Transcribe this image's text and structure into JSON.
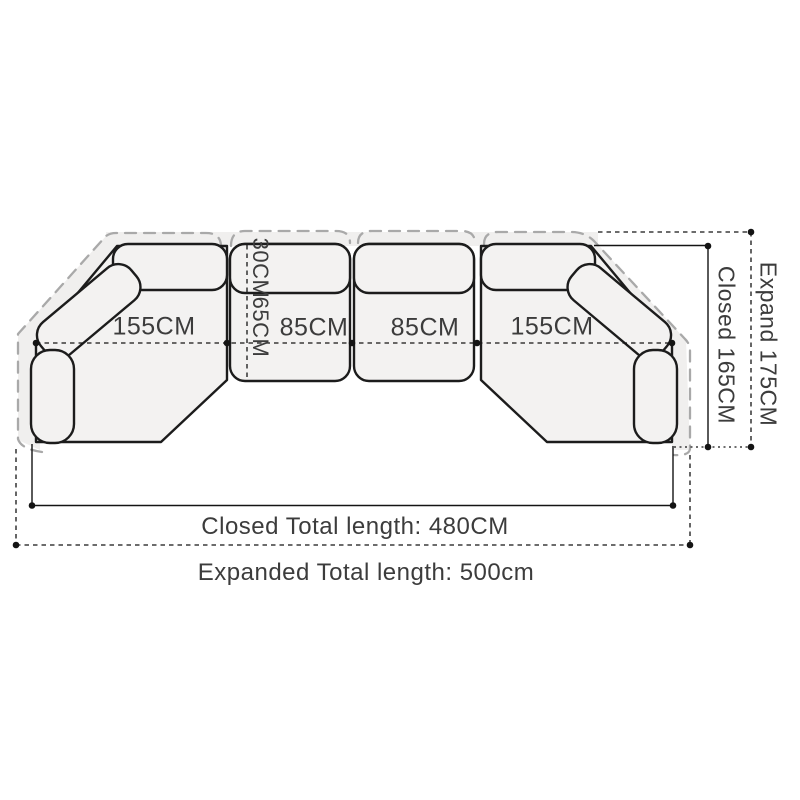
{
  "labels": {
    "left_section": "155CM",
    "middle_section_1": "85CM",
    "middle_section_2": "85CM",
    "right_section": "155CM",
    "backrest_depth": "30CM",
    "seat_depth": "65CM",
    "closed_height": "Closed 165CM",
    "expanded_height": "Expand 175CM",
    "closed_total": "Closed Total length: 480CM",
    "expanded_total": "Expanded Total length: 500cm"
  },
  "colors": {
    "outline": "#1c1c1c",
    "expanded_outline": "#a9a9a9",
    "sofa_fill": "#f3f2f1",
    "expanded_fill": "#f0efee",
    "dimension": "#141414",
    "text": "#3c3c3c",
    "bg": "#ffffff"
  }
}
